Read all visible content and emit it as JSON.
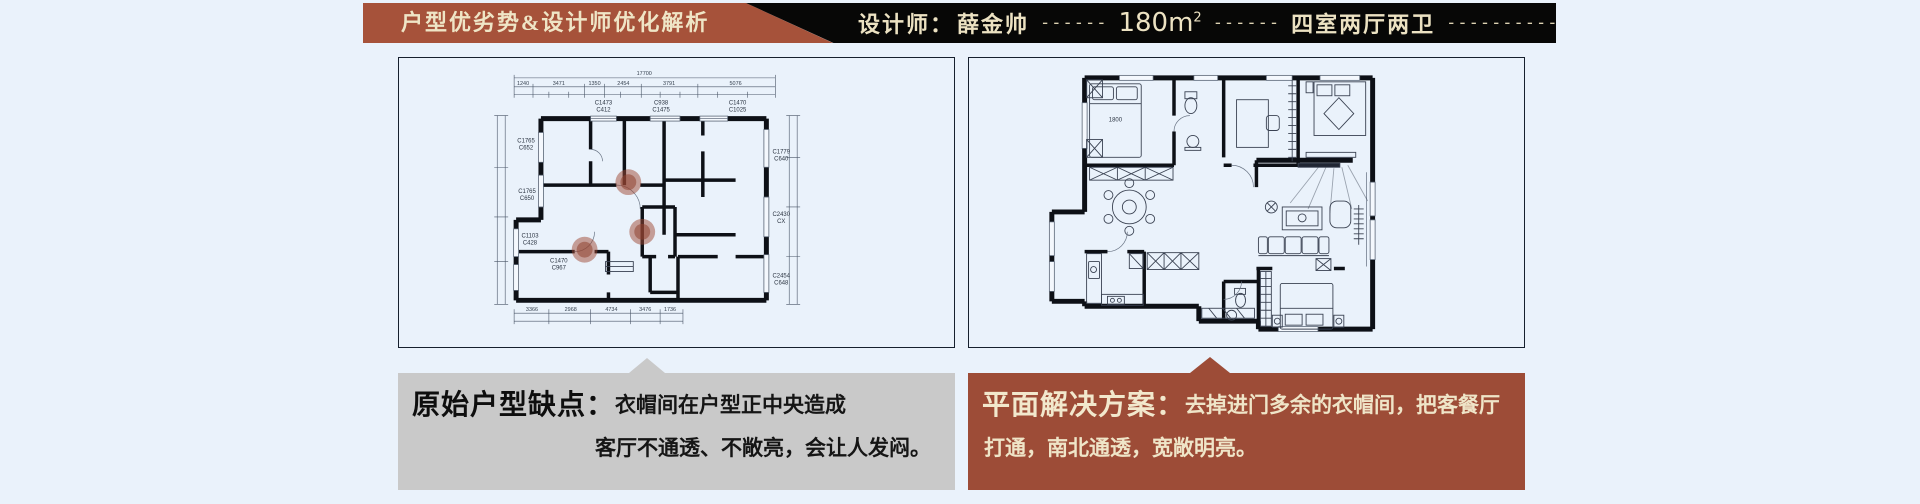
{
  "colors": {
    "page_bg": "#eaf2fb",
    "banner_red": "#a6523a",
    "banner_black": "#070706",
    "banner_text_cream": "#efe5c6",
    "note_gray_bg": "#c9c9c9",
    "note_red_bg": "#9d4c37",
    "problem_marker": "#9e4834",
    "panel_border": "#16202e"
  },
  "banner": {
    "left": {
      "text": "户型优劣势&设计师优化解析"
    },
    "right": {
      "designer_label": "设计师：",
      "designer_name": "薛金帅",
      "dash_1": "------",
      "area_value": "180m",
      "area_sup": "2",
      "dash_2": "------",
      "rooms_text": "四室两厅两卫",
      "dash_3": "--------------------"
    }
  },
  "plans": {
    "original": {
      "dim_total_top": "17700",
      "dims_top": [
        "1240",
        "3471",
        "1350",
        "2454",
        "3791",
        "5076"
      ],
      "dims_bottom": [
        "3366",
        "2968",
        "4734",
        "3476",
        "1736"
      ],
      "window_codes": [
        {
          "l1": "C1473",
          "l2": "C412"
        },
        {
          "l1": "C938",
          "l2": "C1475"
        },
        {
          "l1": "C1470",
          "l2": "C1025"
        },
        {
          "l1": "C1765",
          "l2": "C652"
        },
        {
          "l1": "C1765",
          "l2": "C650"
        },
        {
          "l1": "C1103",
          "l2": "C428"
        },
        {
          "l1": "C1470",
          "l2": "C967"
        },
        {
          "l1": "C1779",
          "l2": "C640"
        },
        {
          "l1": "C2430",
          "l2": "CX"
        },
        {
          "l1": "C2454",
          "l2": "C648"
        }
      ]
    },
    "optimized": {
      "bed_dim": "1800"
    }
  },
  "notes": {
    "original": {
      "title": "原始户型缺点：",
      "line1": "衣帽间在户型正中央造成",
      "line2": "客厅不通透、不敞亮，会让人发闷。"
    },
    "solution": {
      "title": "平面解决方案：",
      "line1": "去掉进门多余的衣帽间，把客餐厅",
      "line2": "打通，南北通透，宽敞明亮。"
    }
  }
}
